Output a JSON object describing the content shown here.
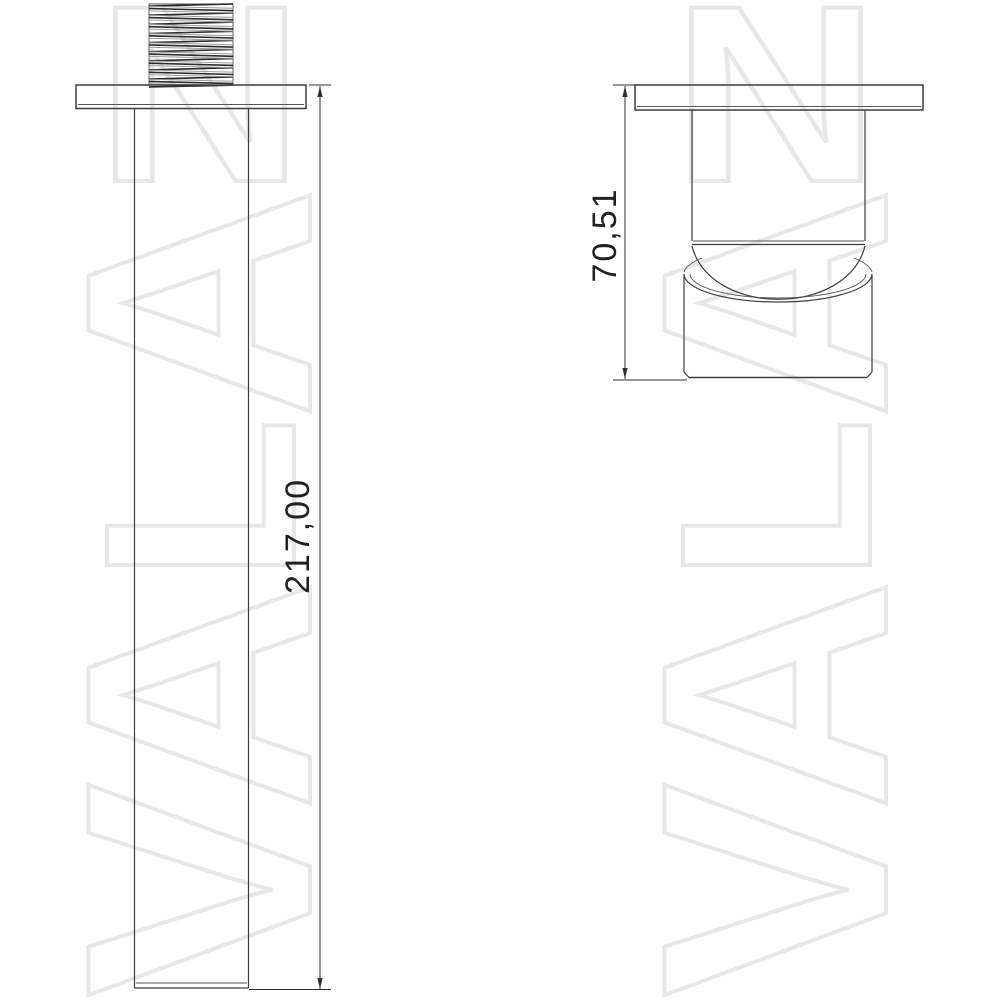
{
  "drawing": {
    "background_color": "#ffffff",
    "line_color": "#3d3d3d",
    "dimension_text_color": "#222222",
    "dimensions": {
      "length": {
        "value": "217,00"
      },
      "height": {
        "value": "70,51"
      }
    }
  },
  "watermark": {
    "word": "VALAN",
    "display_letters": [
      "N",
      "A",
      "L",
      "A",
      "V"
    ],
    "color": "#e7e7e7"
  }
}
